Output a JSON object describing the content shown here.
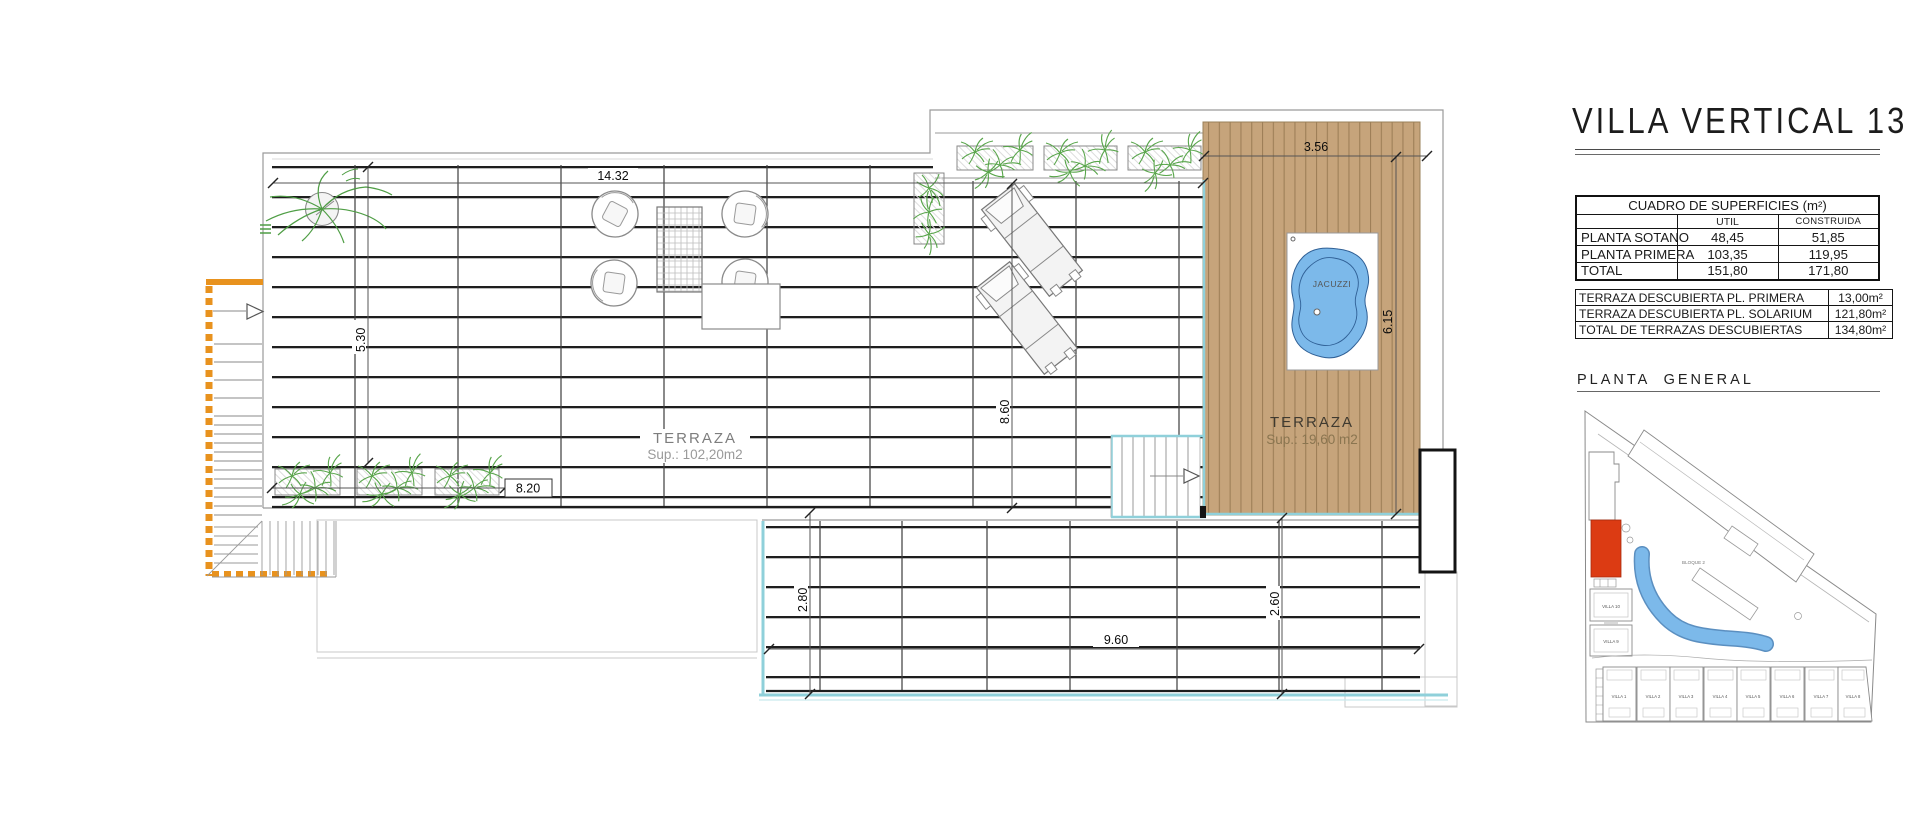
{
  "header": {
    "title": "VILLA VERTICAL 13",
    "planta_general_label": "PLANTA  GENERAL"
  },
  "surfaces_table": {
    "title": "CUADRO DE SUPERFICIES (m²)",
    "columns": {
      "util": "UTIL",
      "construida": "CONSTRUIDA"
    },
    "rows": [
      {
        "label": "PLANTA SOTANO",
        "util": "48,45",
        "construida": "51,85"
      },
      {
        "label": "PLANTA PRIMERA",
        "util": "103,35",
        "construida": "119,95"
      },
      {
        "label": "TOTAL",
        "util": "151,80",
        "construida": "171,80"
      }
    ]
  },
  "terraces_table": {
    "rows": [
      {
        "label": "TERRAZA DESCUBIERTA PL. PRIMERA",
        "value": "13,00m²"
      },
      {
        "label": "TERRAZA DESCUBIERTA PL. SOLARIUM",
        "value": "121,80m²"
      },
      {
        "label": "TOTAL DE TERRAZAS DESCUBIERTAS",
        "value": "134,80m²"
      }
    ]
  },
  "floor_plan": {
    "main_terrace": {
      "label": "TERRAZA",
      "area": "Sup.: 102,20m2"
    },
    "solarium_terrace": {
      "label": "TERRAZA",
      "area": "Sup.: 19,60  m2"
    },
    "jacuzzi_label": "JACUZZI",
    "dimensions": {
      "top_width": "14.32",
      "upper_left_height": "5.30",
      "planter_row_width": "8.20",
      "mid_height": "8.60",
      "deck_width": "3.56",
      "deck_height": "6.15",
      "lower_left_height": "2.80",
      "lower_right_height": "2.60",
      "lower_width": "9.60"
    }
  },
  "site_plan": {
    "block_label": "BLOQUE 2",
    "villa_left_upper": "VILLA 10",
    "villa_left_lower": "VILLA 9",
    "villas_row": [
      "VILLA 1",
      "VILLA 2",
      "VILLA 3",
      "VILLA 4",
      "VILLA 5",
      "VILLA 6",
      "VILLA 7",
      "VILLA 8"
    ]
  },
  "colors": {
    "highlight_red": "#DC3B13",
    "deck_tan": "#C6A47B",
    "pool_blue": "#7CB9EA",
    "water_edge_cyan": "#8FD0DA",
    "stair_orange": "#E8921E",
    "plant_green": "#58A54A"
  }
}
